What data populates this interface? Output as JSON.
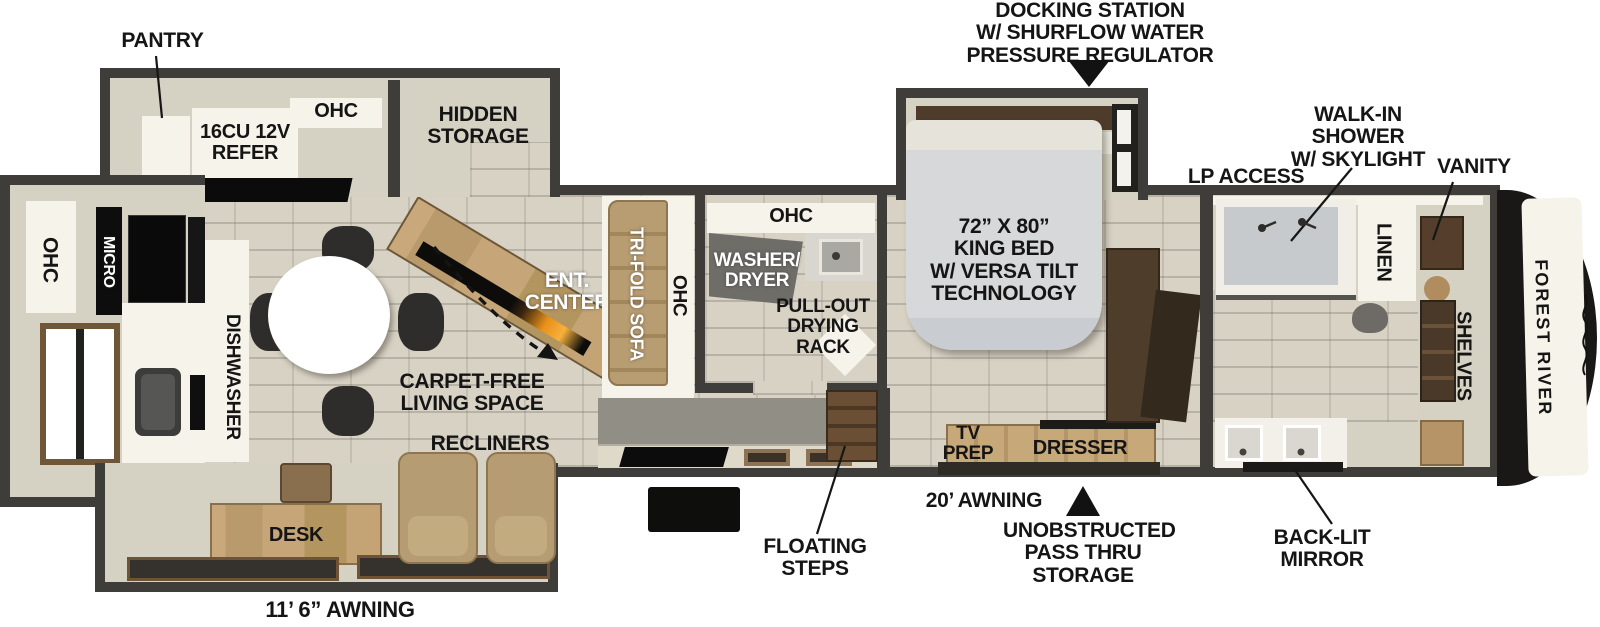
{
  "brand": "FOREST RIVER",
  "callouts": {
    "docking": "DOCKING STATION\nW/ SHURFLOW WATER\nPRESSURE REGULATOR",
    "pantry": "PANTRY",
    "shower": "WALK-IN\nSHOWER\nW/ SKYLIGHT",
    "vanity": "VANITY",
    "lp": "LP ACCESS",
    "awning20": "20’ AWNING",
    "passthru": "UNOBSTRUCTED\nPASS THRU\nSTORAGE",
    "backlit": "BACK-LIT MIRROR",
    "steps": "FLOATING\nSTEPS",
    "awning116": "11’ 6” AWNING",
    "carpet": "CARPET-FREE\nLIVING SPACE",
    "recliners": "RECLINERS"
  },
  "kitchen": {
    "ohc_top": "OHC",
    "refer": "16CU 12V\nREFER",
    "hidden": "HIDDEN\nSTORAGE",
    "ohc_left": "OHC",
    "micro": "MICRO",
    "dishwasher": "DISHWASHER"
  },
  "living": {
    "ent": "ENT.\nCENTER",
    "sofa": "TRI-FOLD SOFA",
    "ohc_side": "OHC",
    "desk": "DESK"
  },
  "laundry": {
    "ohc": "OHC",
    "washer": "WASHER/\nDRYER",
    "rack": "PULL-OUT\nDRYING\nRACK"
  },
  "bedroom": {
    "bed": "72” X 80”\nKING BED\nW/ VERSA TILT\nTECHNOLOGY",
    "tvprep": "TV\nPREP",
    "dresser": "DRESSER"
  },
  "bathroom": {
    "linen": "LINEN",
    "shelves": "SHELVES"
  }
}
